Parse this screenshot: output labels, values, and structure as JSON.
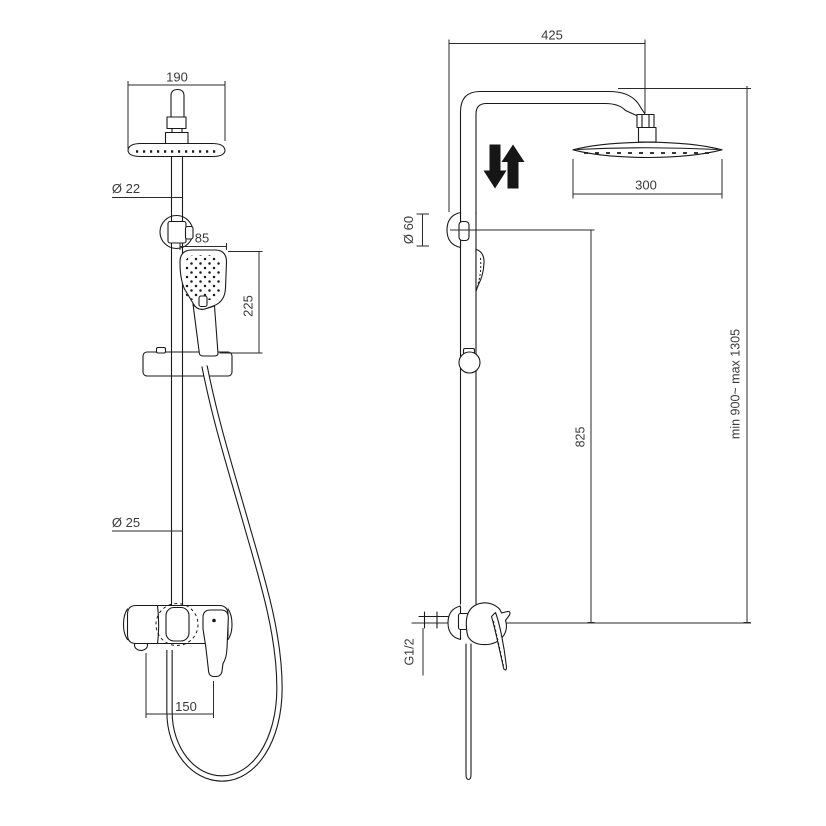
{
  "title": "Shower column dimensional drawing",
  "colors": {
    "background": "#ffffff",
    "line": "#1a1a1a",
    "text": "#3a3a3a"
  },
  "front_view": {
    "dims": {
      "head_width": "190",
      "riser_upper_dia": "Ø 22",
      "handshower_width": "85",
      "handshower_length": "225",
      "riser_lower_dia": "Ø 25",
      "mixer_spacing": "150"
    }
  },
  "side_view": {
    "dims": {
      "arm_reach": "425",
      "head_dia": "300",
      "bracket_dia": "Ø 60",
      "bracket_to_inlet": "825",
      "height_range": "min 900~ max 1305",
      "inlet_thread": "G1/2"
    }
  }
}
